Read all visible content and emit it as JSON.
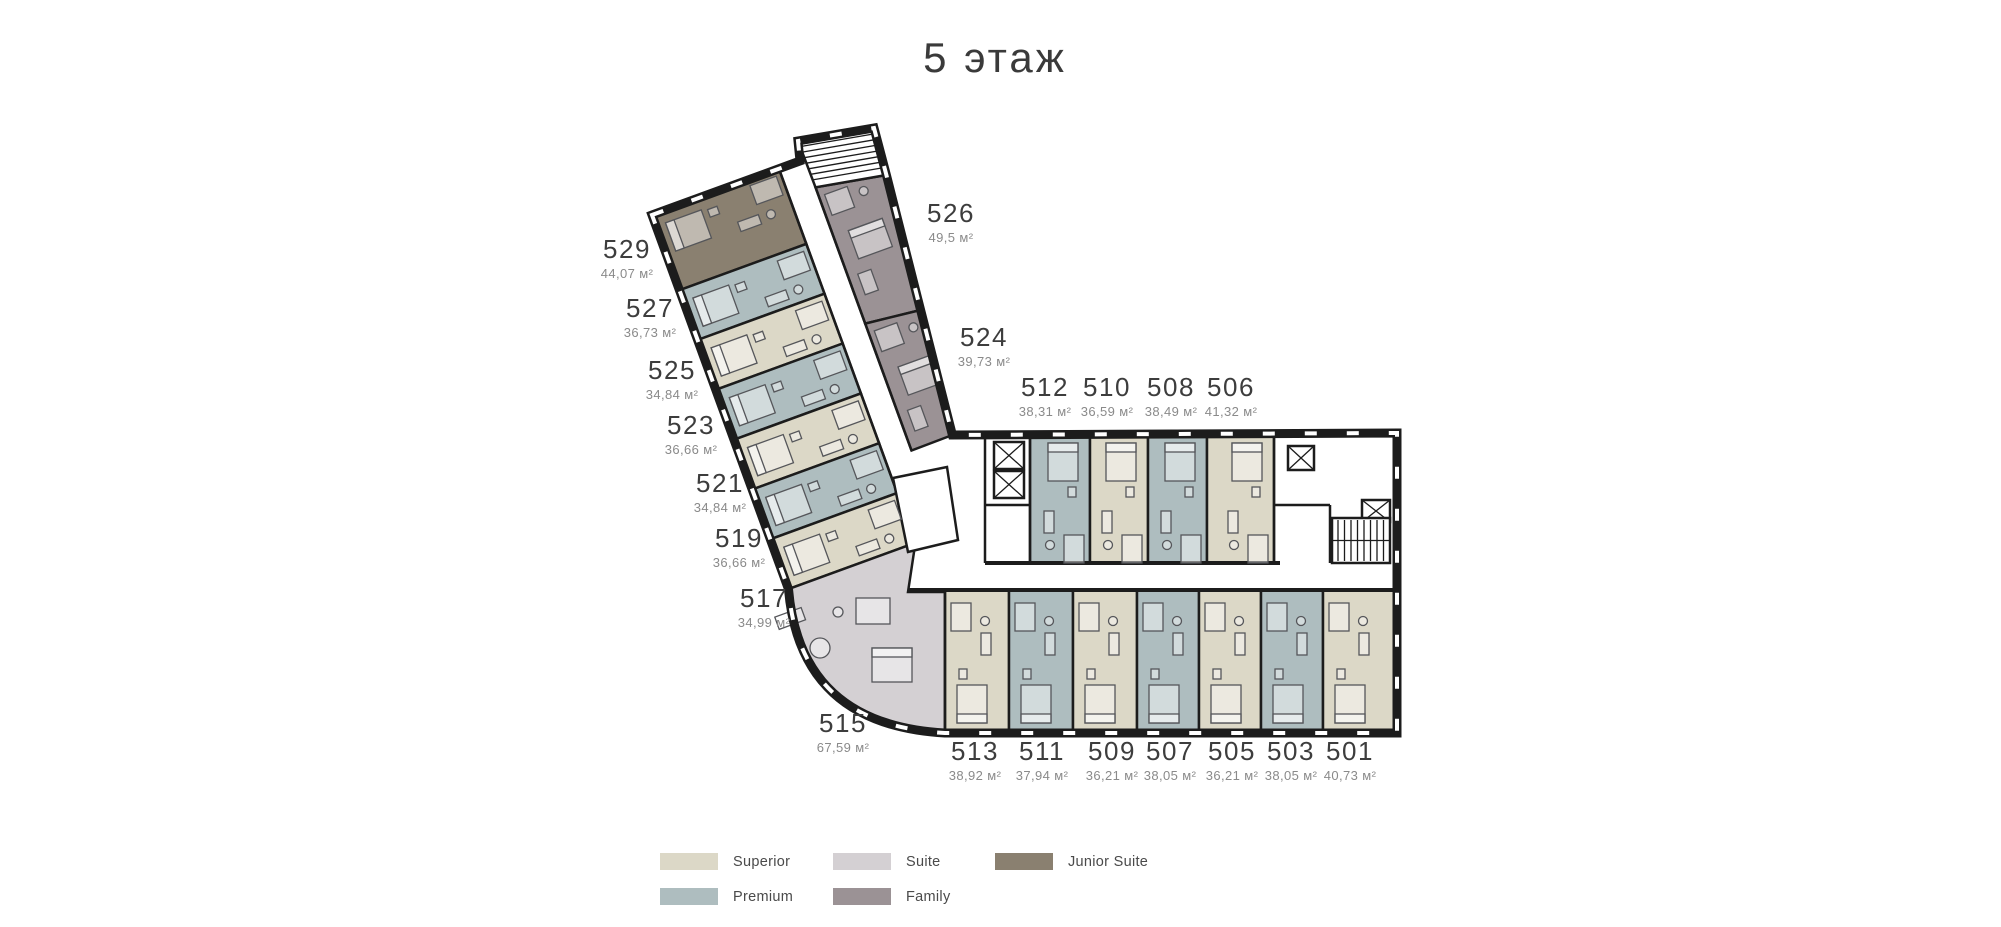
{
  "title": "5 этаж",
  "colors": {
    "superior": "#DCD8C7",
    "premium": "#AEBDBF",
    "suite": "#D4D0D3",
    "family": "#9B9295",
    "junior_suite": "#8A8070",
    "wall": "#1C1C1C",
    "room_number_text": "#3D3D3D",
    "area_text": "#8A8A8A"
  },
  "rooms": [
    {
      "number": "529",
      "area": "44,07 м²",
      "type": "Junior Suite"
    },
    {
      "number": "527",
      "area": "36,73 м²",
      "type": "Premium"
    },
    {
      "number": "525",
      "area": "34,84 м²",
      "type": "Superior"
    },
    {
      "number": "523",
      "area": "36,66 м²",
      "type": "Premium"
    },
    {
      "number": "521",
      "area": "34,84 м²",
      "type": "Superior"
    },
    {
      "number": "519",
      "area": "36,66 м²",
      "type": "Premium"
    },
    {
      "number": "517",
      "area": "34,99 м²",
      "type": "Superior"
    },
    {
      "number": "515",
      "area": "67,59 м²",
      "type": "Suite"
    },
    {
      "number": "526",
      "area": "49,5 м²",
      "type": "Family"
    },
    {
      "number": "524",
      "area": "39,73 м²",
      "type": "Family"
    },
    {
      "number": "512",
      "area": "38,31 м²",
      "type": "Premium"
    },
    {
      "number": "510",
      "area": "36,59 м²",
      "type": "Superior"
    },
    {
      "number": "508",
      "area": "38,49 м²",
      "type": "Premium"
    },
    {
      "number": "506",
      "area": "41,32 м²",
      "type": "Superior"
    },
    {
      "number": "513",
      "area": "38,92 м²",
      "type": "Superior"
    },
    {
      "number": "511",
      "area": "37,94 м²",
      "type": "Premium"
    },
    {
      "number": "509",
      "area": "36,21 м²",
      "type": "Superior"
    },
    {
      "number": "507",
      "area": "38,05 м²",
      "type": "Premium"
    },
    {
      "number": "505",
      "area": "36,21 м²",
      "type": "Superior"
    },
    {
      "number": "503",
      "area": "38,05 м²",
      "type": "Premium"
    },
    {
      "number": "501",
      "area": "40,73 м²",
      "type": "Superior"
    }
  ],
  "legend": {
    "items": [
      {
        "label": "Superior",
        "color": "#DCD8C7"
      },
      {
        "label": "Premium",
        "color": "#AEBDBF"
      },
      {
        "label": "Suite",
        "color": "#D4D0D3"
      },
      {
        "label": "Family",
        "color": "#9B9295"
      },
      {
        "label": "Junior Suite",
        "color": "#8A8070"
      }
    ]
  }
}
